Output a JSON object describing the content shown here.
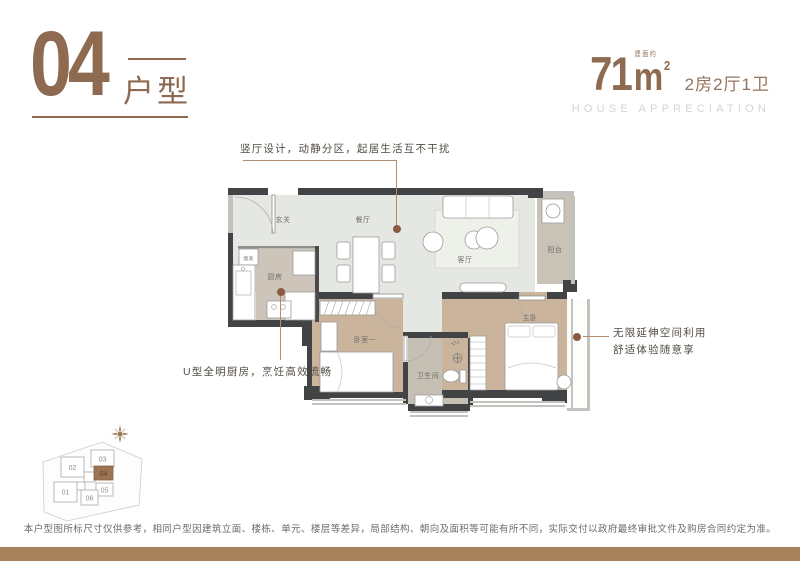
{
  "header": {
    "unit_number": "04",
    "unit_label": "户型",
    "area_value": "71",
    "area_unit": "m",
    "area_sup": "2",
    "area_prefix": "建面约",
    "layout_spec": "2房2厅1卫",
    "subtitle_en": "HOUSE APPRECIATION"
  },
  "annotations": {
    "living": "竖厅设计，动静分区，起居生活互不干扰",
    "kitchen": "U型全明厨房，烹饪高效流畅",
    "master_line1": "无限延伸空间利用",
    "master_line2": "舒适体验随意享"
  },
  "floorplan": {
    "rooms": {
      "entry": "玄关",
      "dining": "餐厅",
      "living": "客厅",
      "balcony": "阳台",
      "kitchen": "厨房",
      "flue": "烟道",
      "bedroom1": "卧室一",
      "bathroom": "卫生间",
      "master": "主卧"
    }
  },
  "siteplan": {
    "units": [
      "01",
      "02",
      "03",
      "04",
      "05",
      "06"
    ],
    "highlighted": "04"
  },
  "disclaimer": "本户型图所标尺寸仅供参考，相同户型因建筑立面、楼栋、单元、楼层等差异，局部结构、朝向及面积等可能有所不同，实际交付以政府最终审批文件及购房合同约定为准。",
  "colors": {
    "accent": "#8d6a50",
    "wall": "#414345",
    "window": "#c2c2bf",
    "floor_living": "#e5e7e2",
    "floor_stone": "#cdc5b9",
    "floor_wood": "#cab49c",
    "leader_dot": "#8a5a42",
    "footer_band": "#a8825a"
  }
}
